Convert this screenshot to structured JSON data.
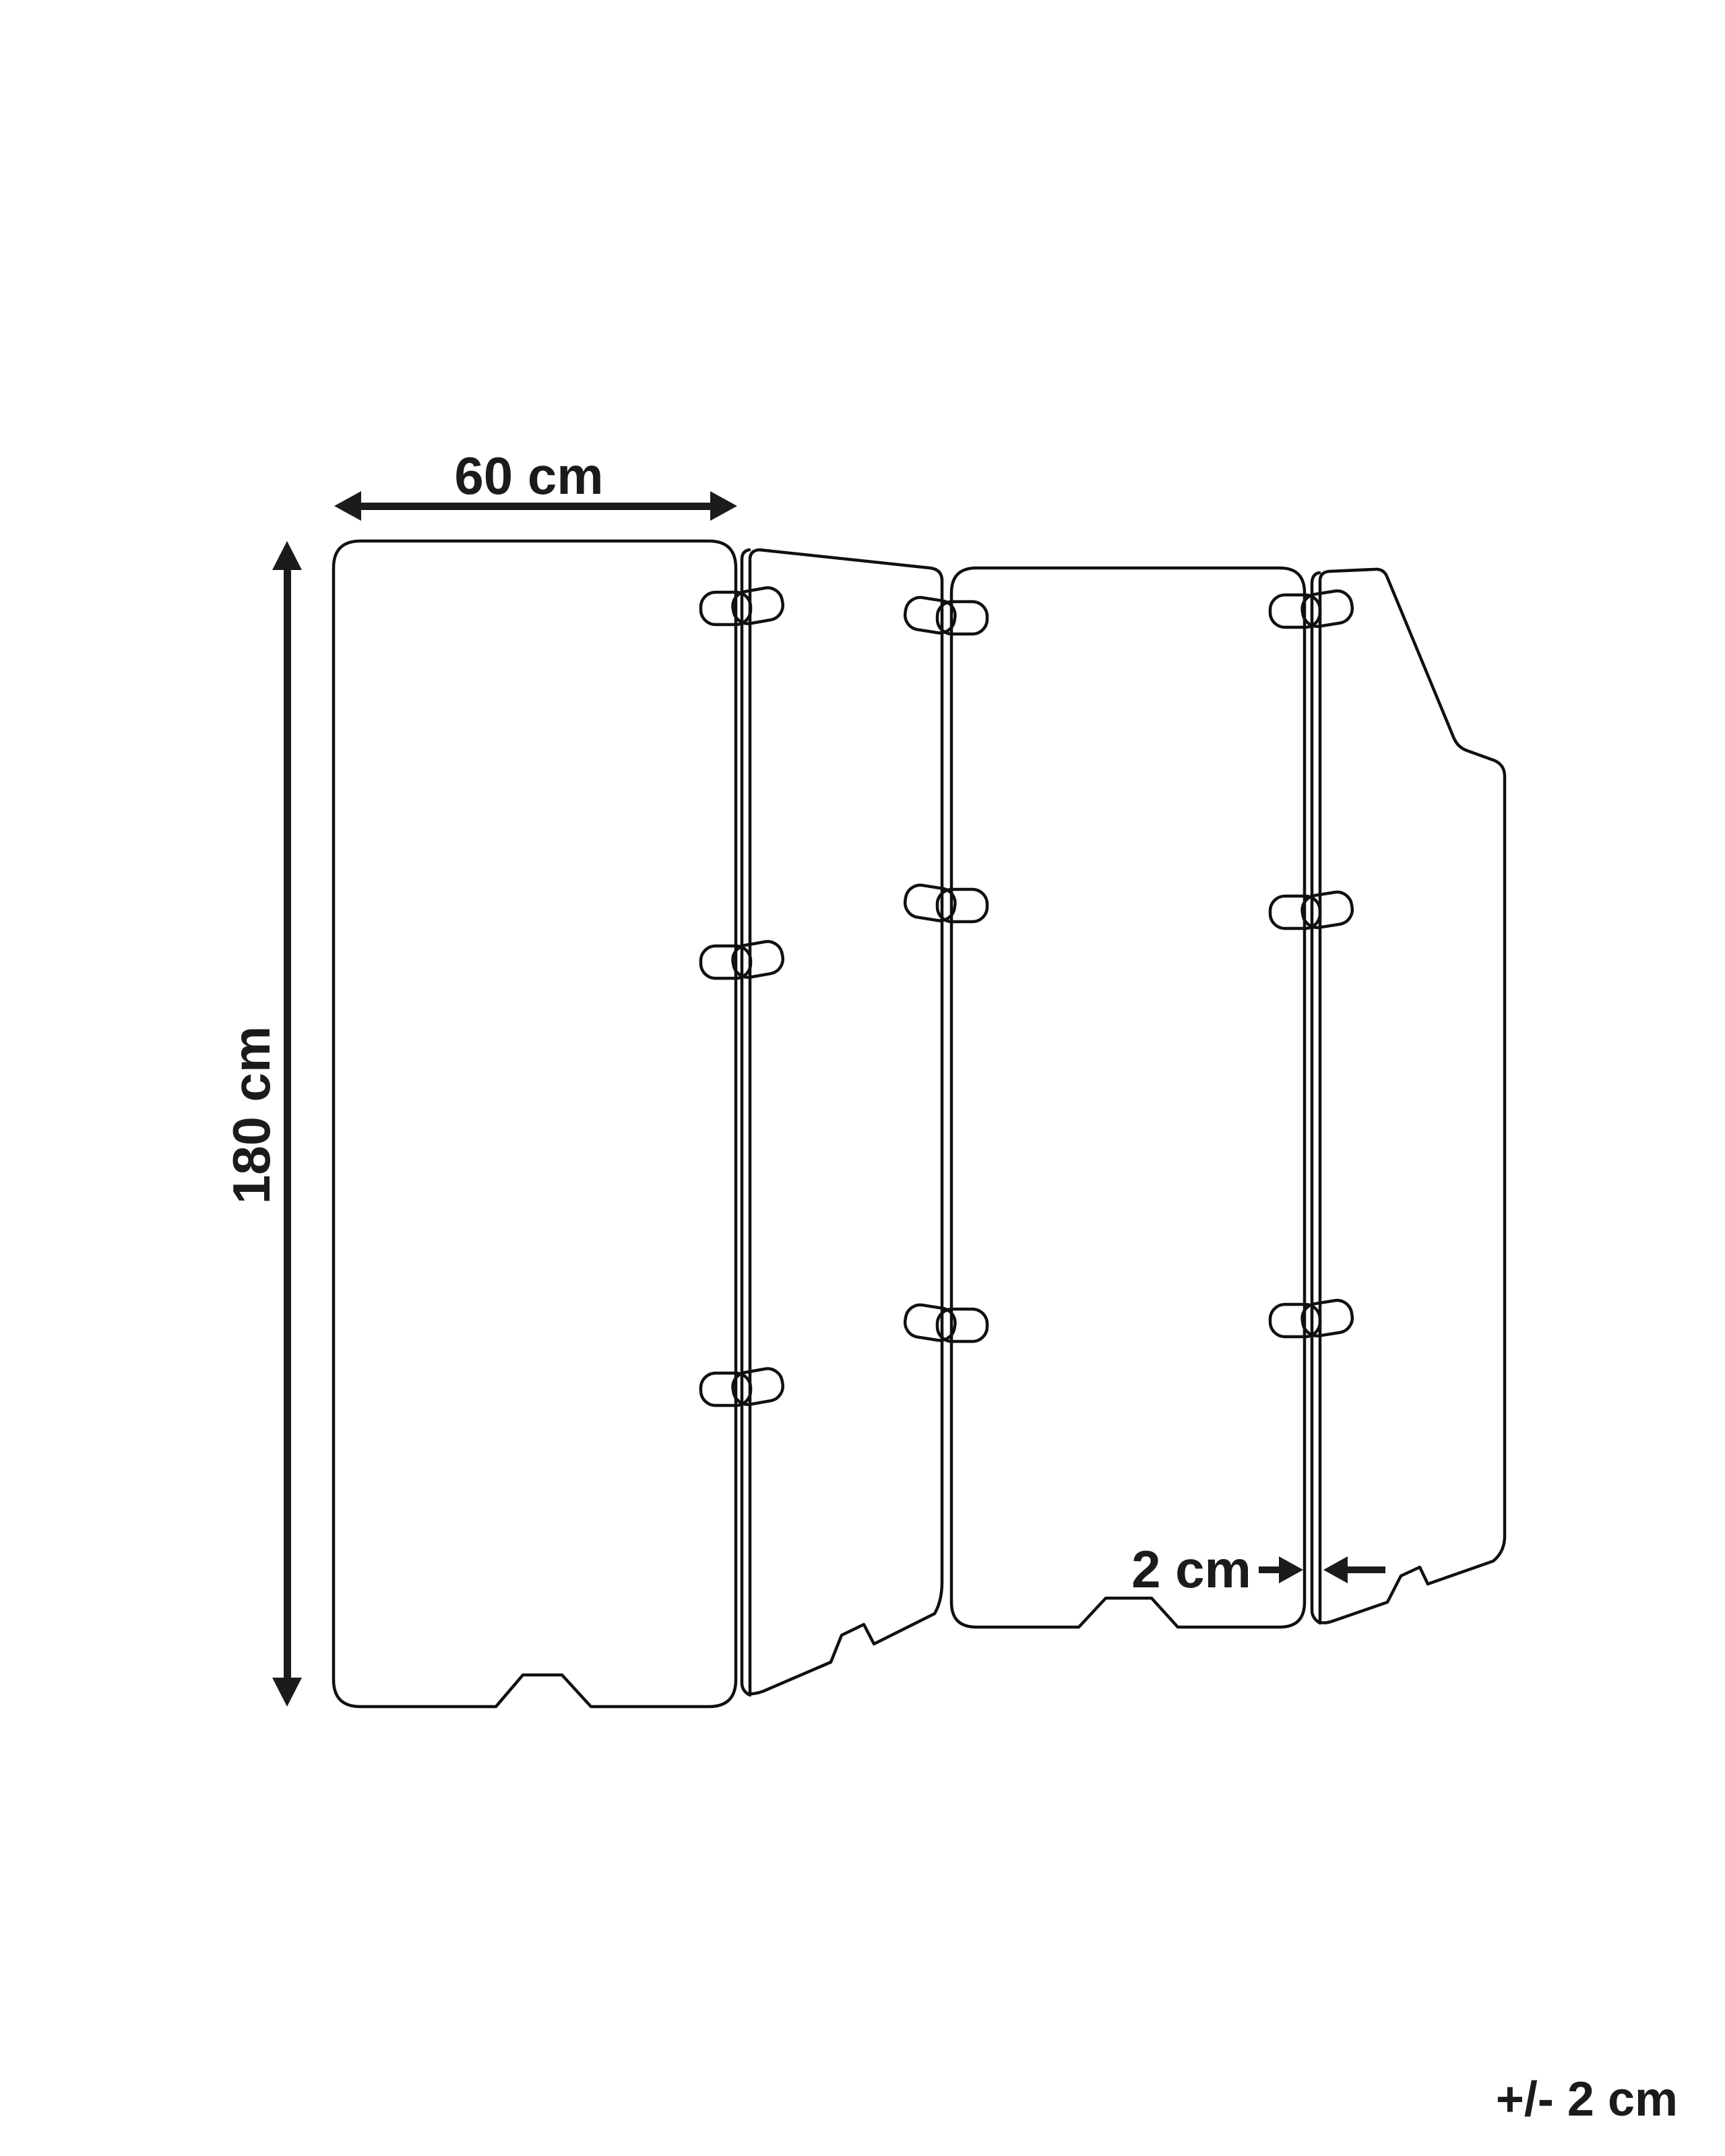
{
  "diagram": {
    "type": "furniture-dimension-diagram",
    "subject": "4-panel folding room divider screen",
    "panels": 4,
    "clips_per_joint": 3,
    "labels": {
      "width": "60 cm",
      "height": "180 cm",
      "thickness": "2 cm",
      "tolerance": "+/- 2 cm"
    },
    "colors": {
      "line": "#101010",
      "text": "#1b1b1b",
      "background": "#ffffff"
    }
  }
}
